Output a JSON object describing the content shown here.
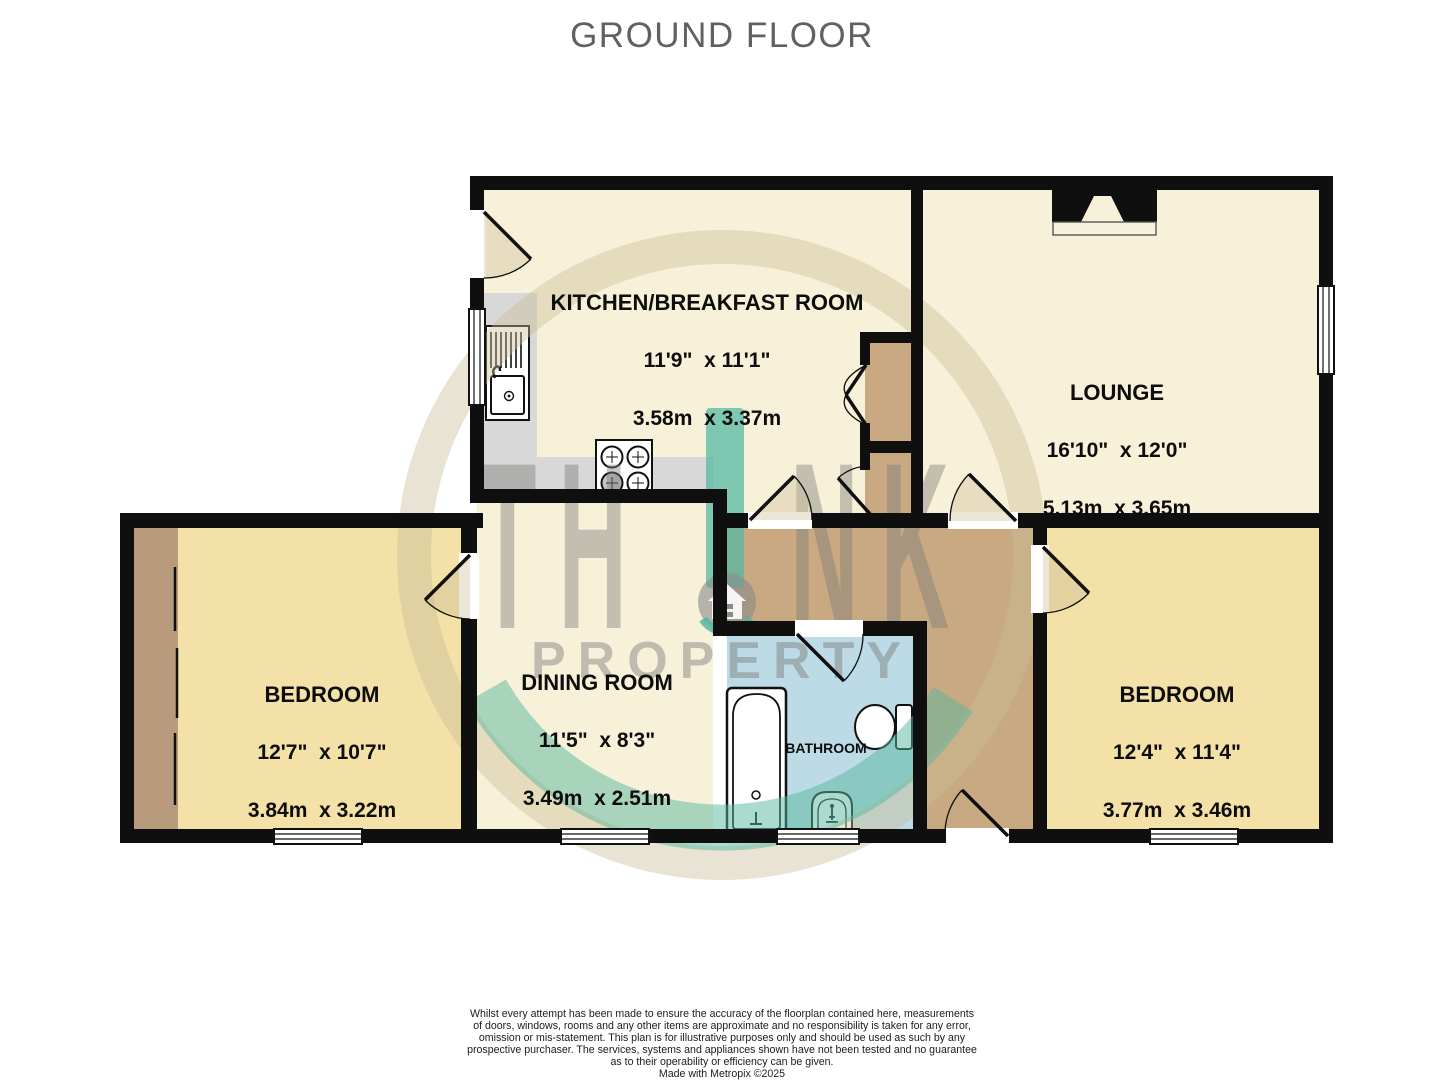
{
  "title": "GROUND FLOOR",
  "rooms": [
    {
      "id": "kitchen",
      "name": "KITCHEN/BREAKFAST ROOM",
      "imperial": "11'9\"  x 11'1\"",
      "metric": "3.58m  x 3.37m"
    },
    {
      "id": "lounge",
      "name": "LOUNGE",
      "imperial": "16'10\"  x 12'0\"",
      "metric": "5.13m  x 3.65m"
    },
    {
      "id": "bedroom-left",
      "name": "BEDROOM",
      "imperial": "12'7\"  x 10'7\"",
      "metric": "3.84m  x 3.22m"
    },
    {
      "id": "dining-room",
      "name": "DINING ROOM",
      "imperial": "11'5\"  x 8'3\"",
      "metric": "3.49m  x 2.51m"
    },
    {
      "id": "bedroom-right",
      "name": "BEDROOM",
      "imperial": "12'4\"  x 11'4\"",
      "metric": "3.77m  x 3.46m"
    },
    {
      "id": "bathroom",
      "name": "BATHROOM"
    }
  ],
  "watermark": {
    "brand_left": "TH",
    "brand_right": "NK",
    "brand_word": "PROPERTY"
  },
  "disclaimer": {
    "lines": [
      "Whilst every attempt has been made to ensure the accuracy of the floorplan contained here, measurements",
      "of doors, windows, rooms and any other items are approximate and no responsibility is taken for any error,",
      "omission or mis-statement. This plan is for illustrative purposes only and should be used as such by any",
      "prospective purchaser. The services, systems and appliances shown have not been tested and no guarantee",
      "as to their operability or efficiency can be given."
    ],
    "credit": "Made with Metropix ©2025"
  },
  "colors": {
    "wall": "#0f0f0f",
    "living_floor": "#f8f1da",
    "bedroom_floor": "#f3e1a7",
    "bathroom_floor": "#bcdbe6",
    "hall_floor": "#c9a981",
    "wardrobe": "#b79b7c",
    "counter": "#d8d8d8",
    "watermark_teal": "#4fb8a2",
    "watermark_gray": "#7a7a78",
    "watermark_ring": "#cbbd97",
    "title_gray": "#616161"
  }
}
